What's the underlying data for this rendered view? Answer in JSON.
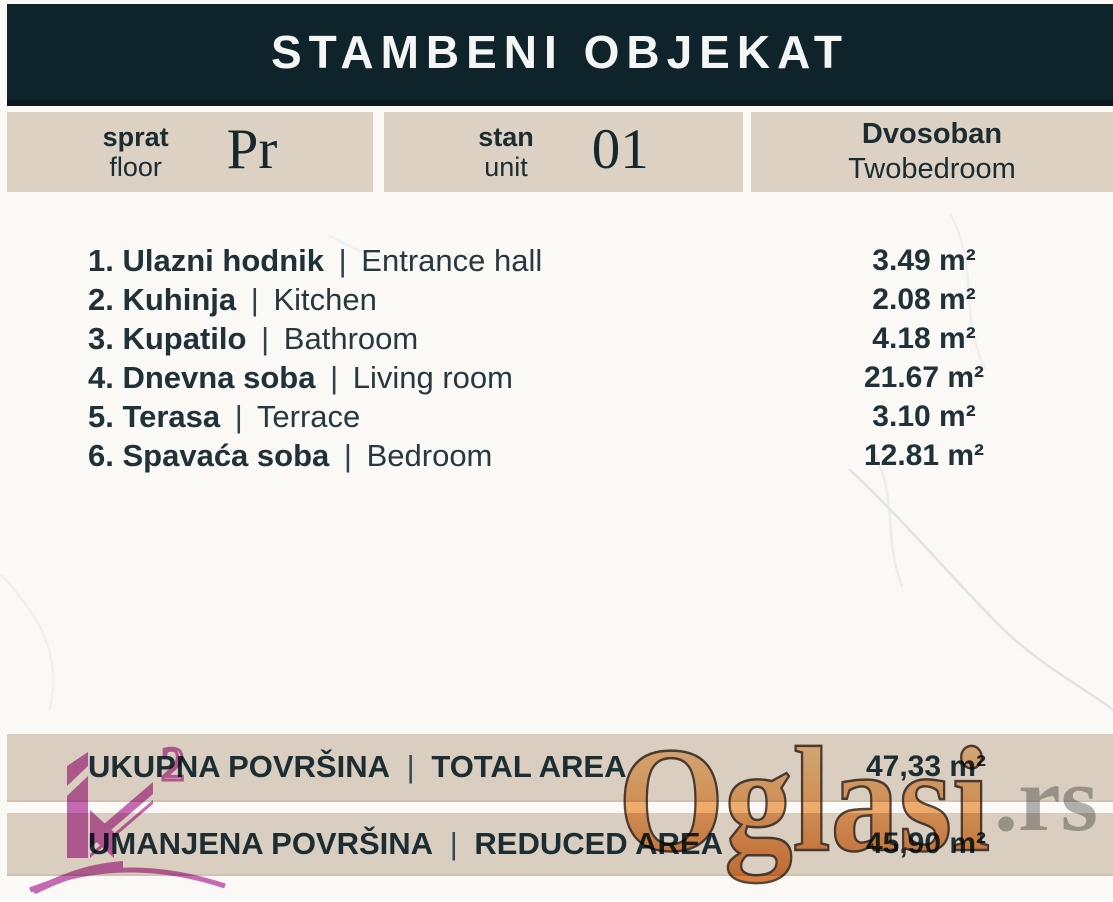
{
  "header": {
    "title": "STAMBENI OBJEKAT"
  },
  "info": {
    "floor": {
      "label_sr": "sprat",
      "label_en": "floor",
      "value": "Pr"
    },
    "unit": {
      "label_sr": "stan",
      "label_en": "unit",
      "value": "01"
    },
    "type": {
      "label_sr": "Dvosoban",
      "label_en": "Twobedroom"
    }
  },
  "sep": "|",
  "rooms": [
    {
      "num": "1.",
      "name_sr": "Ulazni hodnik",
      "name_en": "Entrance hall",
      "area": "3.49 m²"
    },
    {
      "num": "2.",
      "name_sr": "Kuhinja",
      "name_en": "Kitchen",
      "area": "2.08 m²"
    },
    {
      "num": "3.",
      "name_sr": "Kupatilo",
      "name_en": "Bathroom",
      "area": "4.18 m²"
    },
    {
      "num": "4.",
      "name_sr": "Dnevna soba",
      "name_en": "Living room",
      "area": "21.67 m²"
    },
    {
      "num": "5.",
      "name_sr": "Terasa",
      "name_en": "Terrace",
      "area": "3.10 m²"
    },
    {
      "num": "6.",
      "name_sr": "Spavaća soba",
      "name_en": "Bedroom",
      "area": "12.81 m²"
    }
  ],
  "totals": {
    "total": {
      "label_sr": "UKUPNA POVRŠINA",
      "label_en": "TOTAL AREA",
      "value": "47,33 m²"
    },
    "reduced": {
      "label_sr": "UMANJENA POVRŠINA",
      "label_en": "REDUCED AREA",
      "value": "45,90 m²"
    }
  },
  "watermark": {
    "brand": "Oglasi",
    "tld": ".rs",
    "logo_sup": "2"
  },
  "colors": {
    "header_bg": "#0f242a",
    "band_bg": "#dcd1c3",
    "text": "#1c2d33",
    "logo_pink": "#c050ae",
    "brand_orange": "#ee9a52",
    "tld_gray": "#9e9e9e"
  }
}
